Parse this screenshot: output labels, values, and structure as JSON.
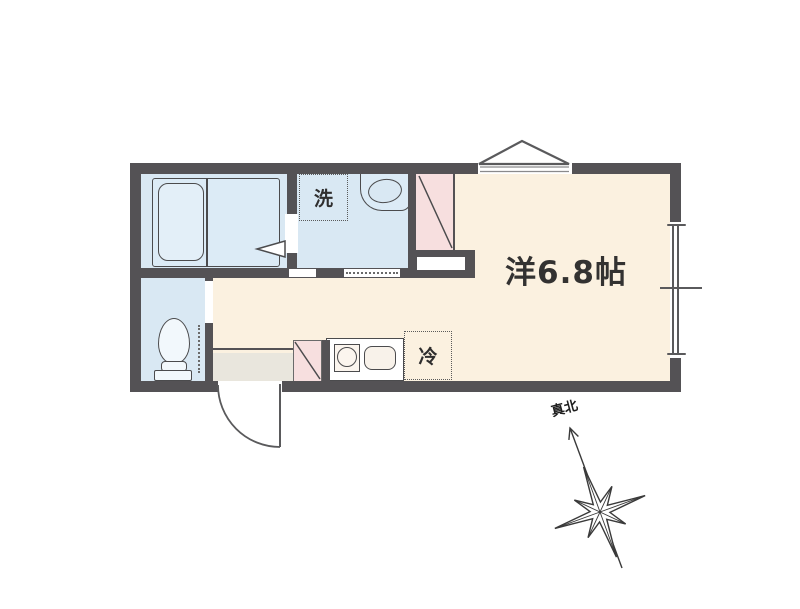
{
  "floorplan": {
    "title": "studio apartment floor plan",
    "rooms": {
      "main_room": {
        "label": "洋6.8帖",
        "type": "western-style room 6.8 jo"
      },
      "bathroom": {
        "type": "unit bath"
      },
      "washroom": {
        "laundry_label": "洗"
      },
      "toilet": {
        "type": "toilet"
      },
      "kitchen": {
        "fridge_label": "冷"
      }
    },
    "compass": {
      "north_label": "真北"
    },
    "colors": {
      "wall": "#545255",
      "wet_area_floor": "#d9e8f3",
      "main_floor": "#fbf1e0",
      "door_swing_pink": "#f7dfdf",
      "entrance_floor": "#e9e6dd",
      "fixture_line": "#4b4b4d"
    }
  }
}
